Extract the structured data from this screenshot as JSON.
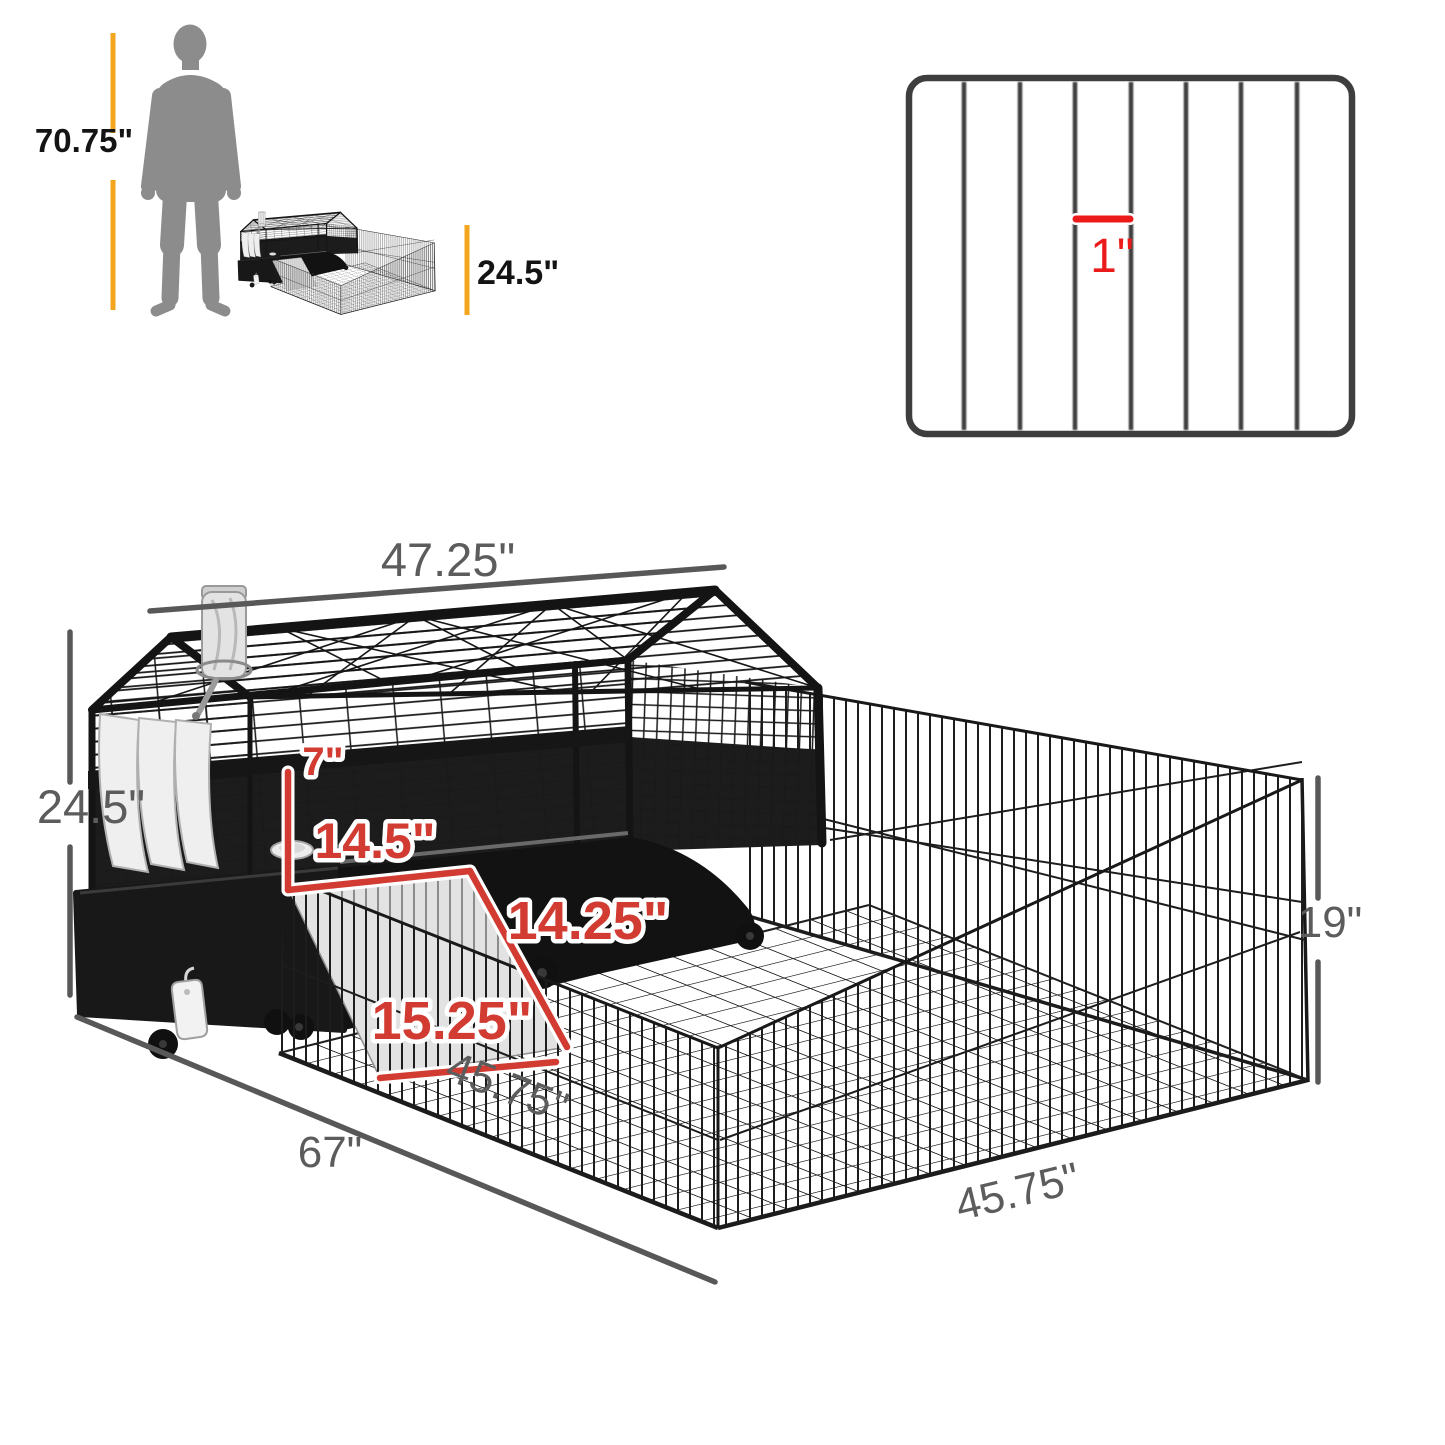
{
  "colors": {
    "amber": "#F2A51D",
    "dim_gray_text": "#5C5C5C",
    "dim_gray_line": "#585858",
    "red_annotation": "#D23B31",
    "panel_red": "#EC1B1B",
    "product_ink": "#161616",
    "silhouette_gray": "#8C8C8C"
  },
  "scale_panel": {
    "person_height": "70.75\"",
    "product_height": "24.5\""
  },
  "bar_panel": {
    "bar_gap": "1\""
  },
  "dimensions": {
    "cage_width": "47.25\"",
    "cage_height": "24.5\"",
    "total_length": "67\"",
    "pen_side_front": "45.75\"",
    "pen_side_right": "45.75\"",
    "pen_height": "19\"",
    "front_opening": "7\"",
    "shelf_depth": "14.5\"",
    "ramp_width": "14.25\"",
    "ramp_length": "15.25\""
  }
}
